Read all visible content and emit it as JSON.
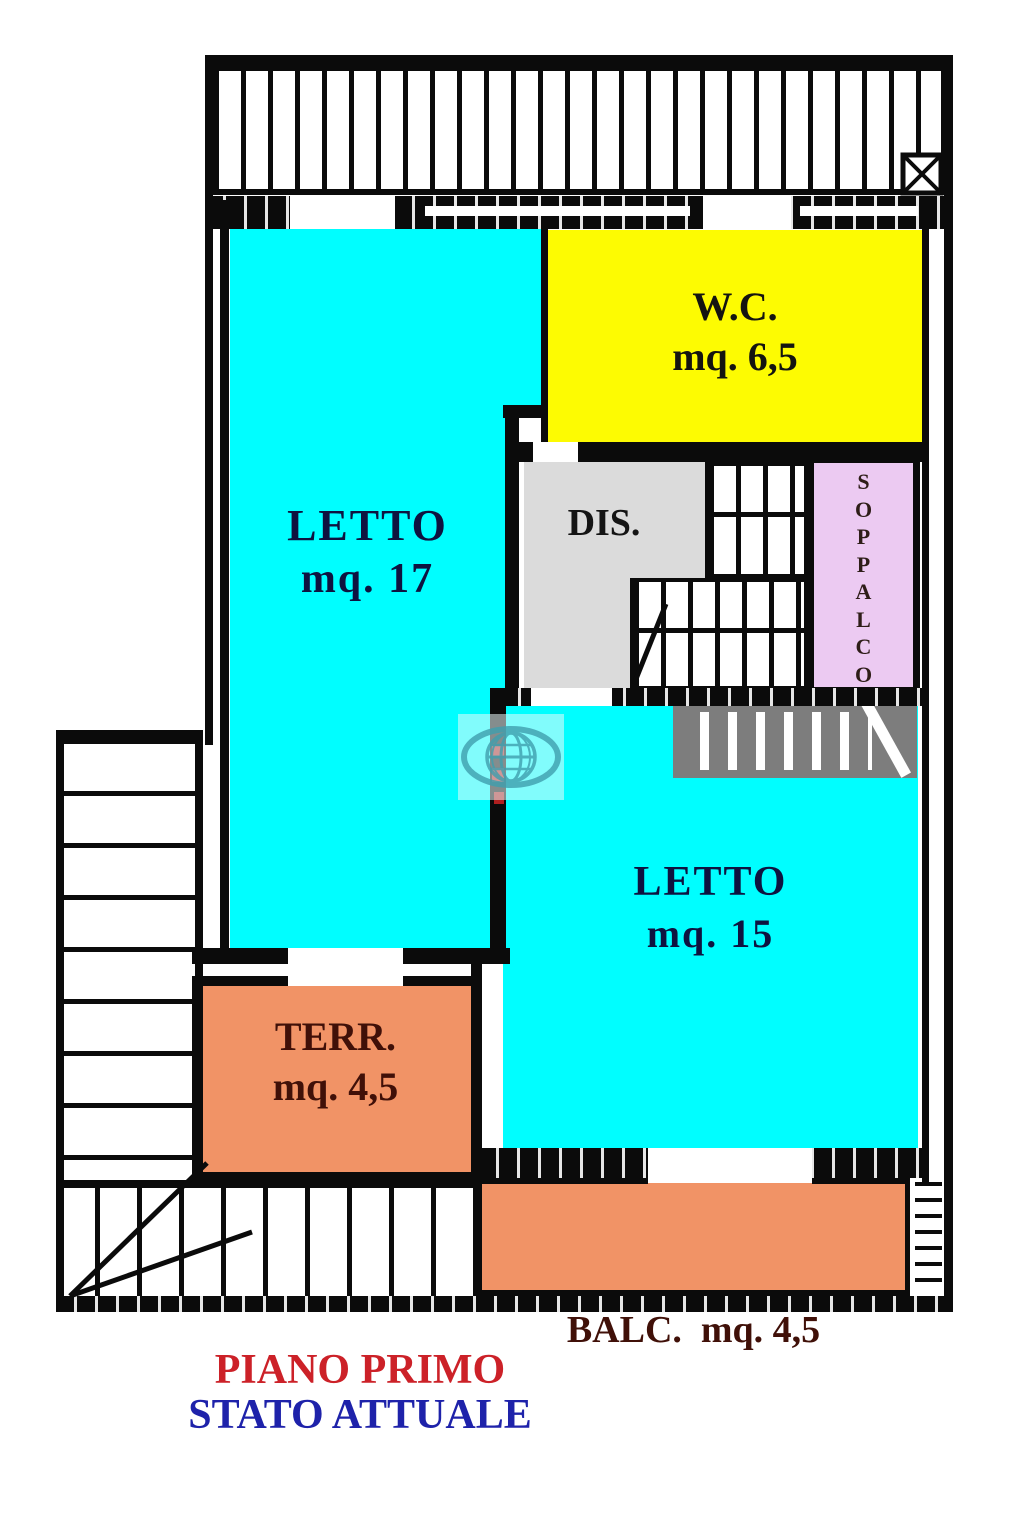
{
  "plan": {
    "caption": {
      "line1": "PIANO PRIMO",
      "line1_color": "#cc2128",
      "line2": "STATO ATTUALE",
      "line2_color": "#1e22aa"
    },
    "rooms": {
      "letto17": {
        "label": "LETTO",
        "area": "mq. 17",
        "fill": "#00feff",
        "text_color": "#0e1340"
      },
      "wc": {
        "label": "W.C.",
        "area": "mq. 6,5",
        "fill": "#fdfb02",
        "text_color": "#141410"
      },
      "dis": {
        "label": "DIS.",
        "fill": "#dbdbdb",
        "text_color": "#141414"
      },
      "soppalco": {
        "label": "SOPPALCO",
        "letters": [
          "S",
          "O",
          "P",
          "P",
          "A",
          "L",
          "C",
          "O"
        ],
        "fill": "#eccaf2",
        "text_color": "#2e1d18"
      },
      "letto15": {
        "label": "LETTO",
        "area": "mq. 15",
        "fill": "#00feff",
        "text_color": "#0e1340"
      },
      "terr": {
        "label": "TERR.",
        "area": "mq. 4,5",
        "fill": "#f19366",
        "text_color": "#401008"
      },
      "balc": {
        "label": "BALC.  mq. 4,5",
        "fill": "#f19366",
        "text_color": "#401008"
      }
    },
    "stairs": {
      "soppalco_band_color": "#7d7d7d"
    },
    "watermark": {
      "icon": "globe-icon",
      "color": "#3f9fae"
    },
    "wall_mark_color": "#ae1f1f"
  }
}
